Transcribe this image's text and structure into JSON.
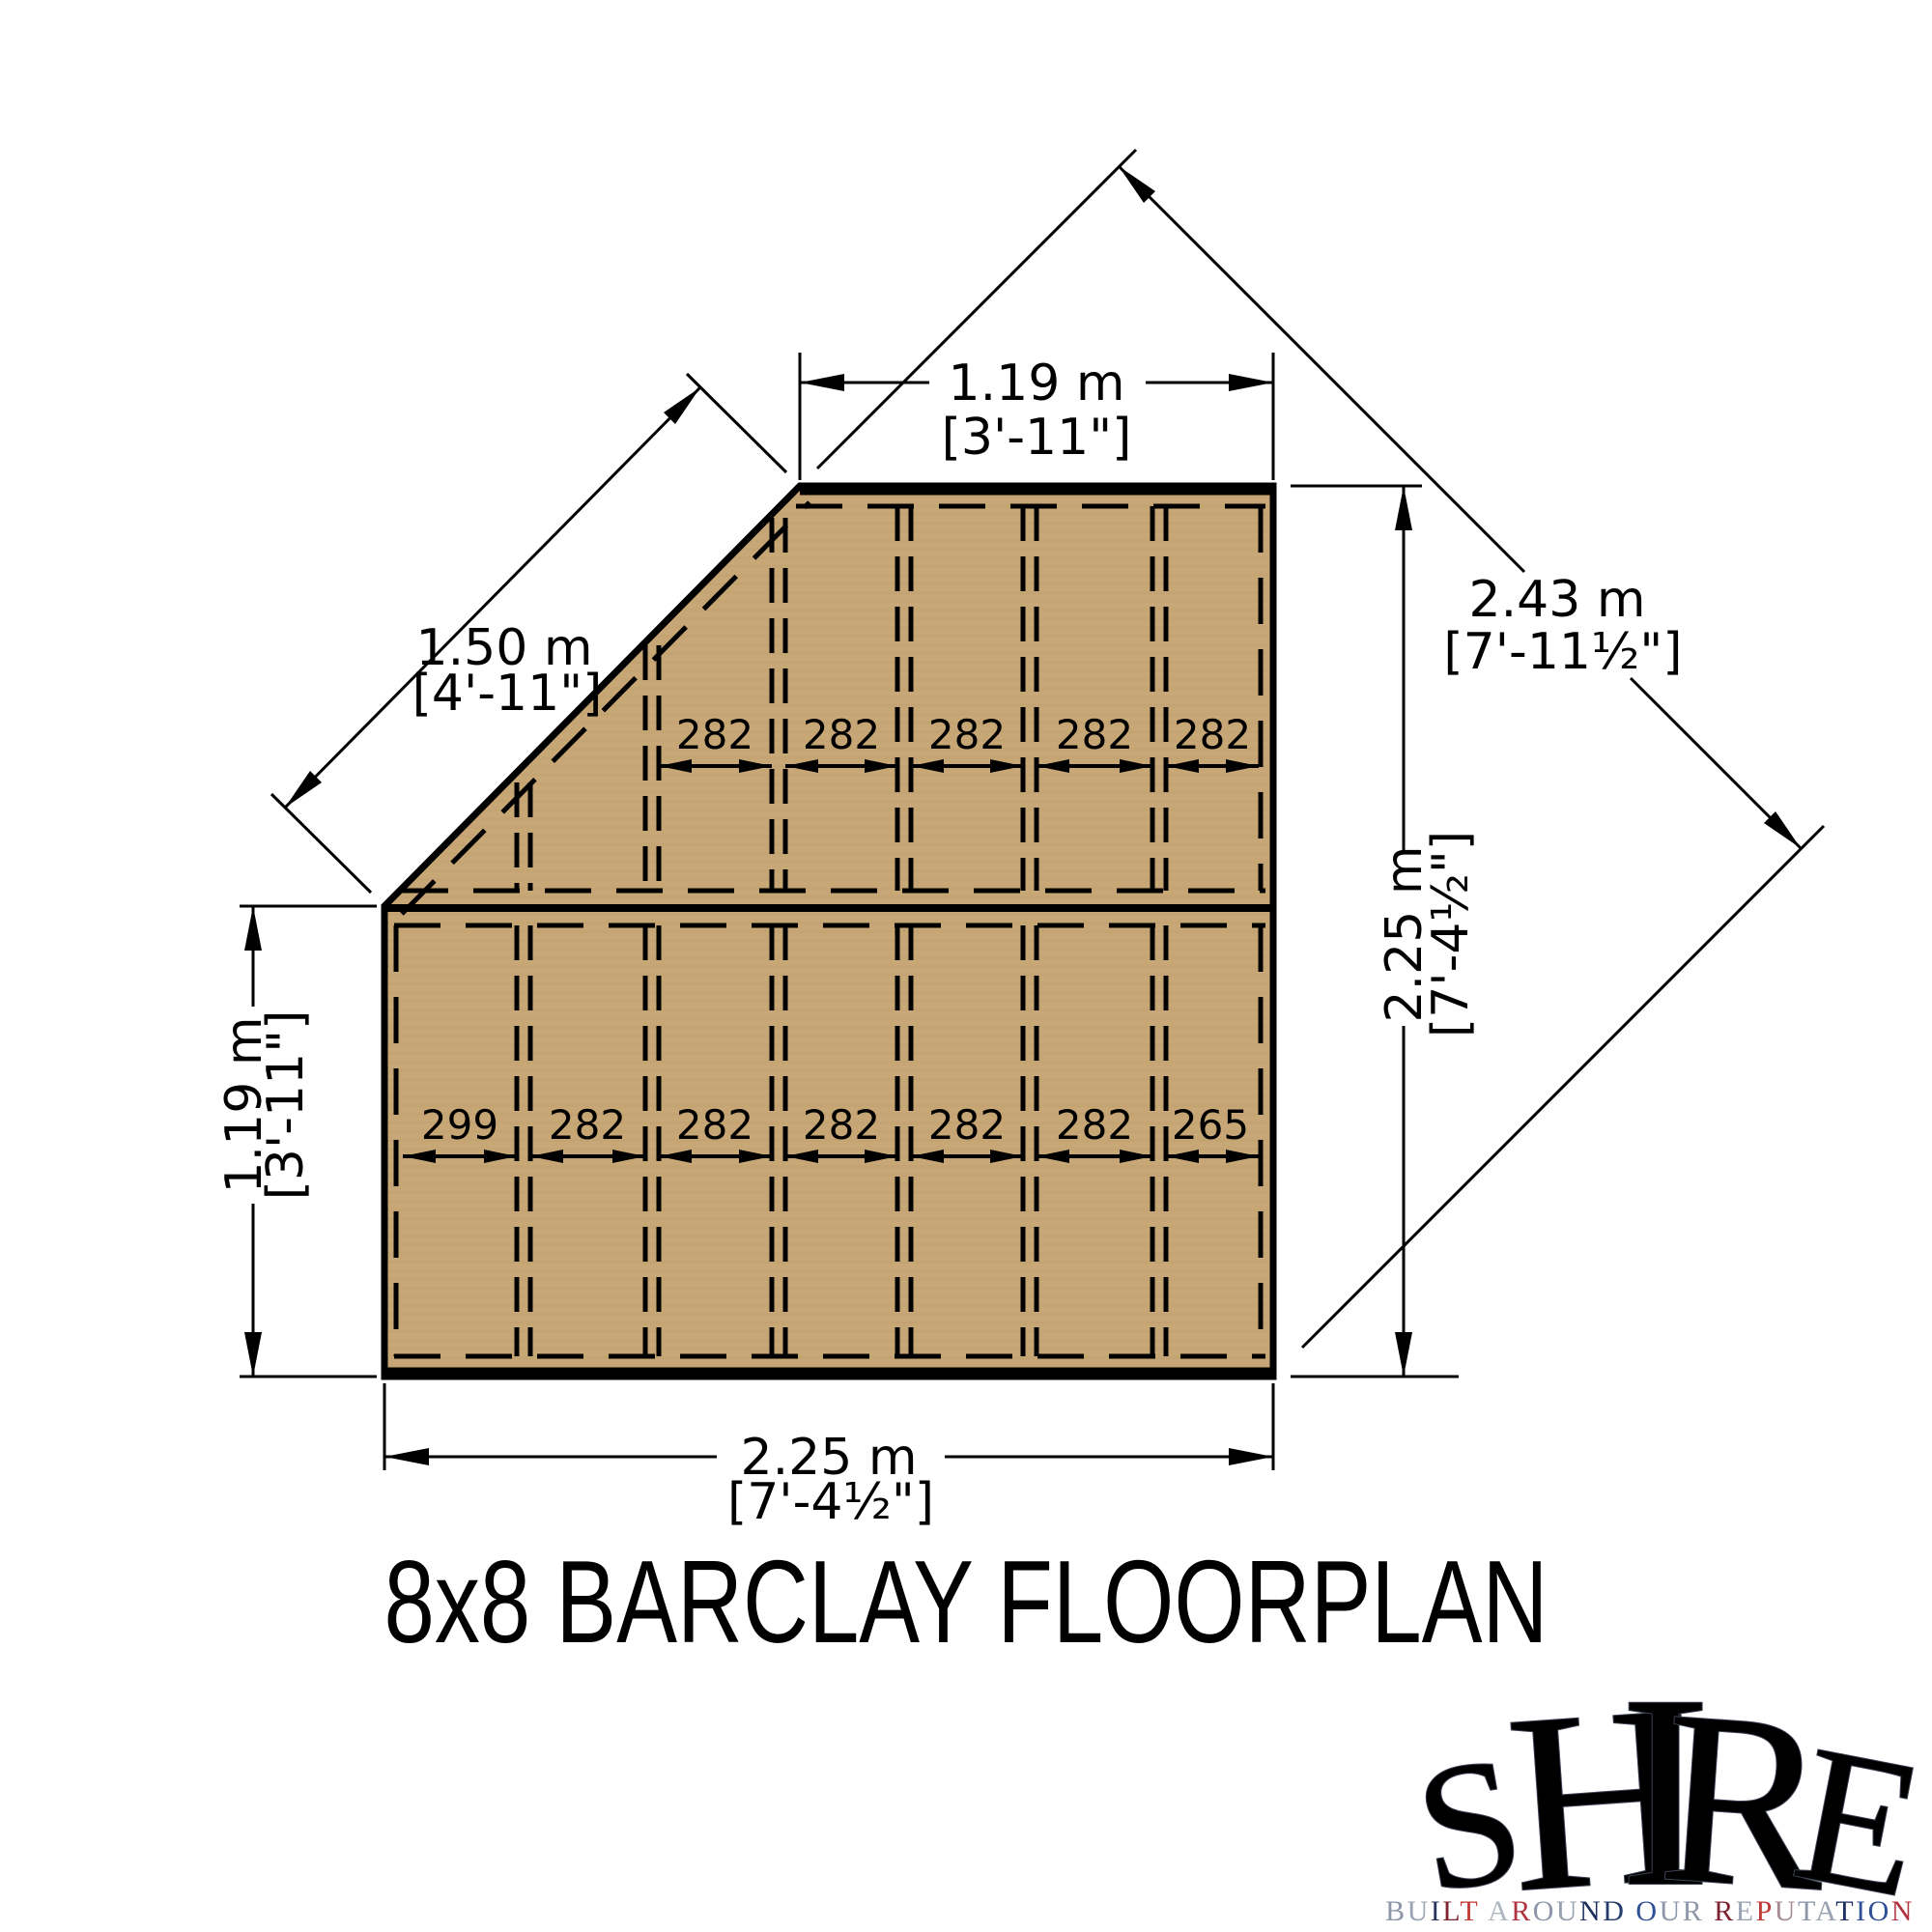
{
  "colors": {
    "floor": "#C8A777",
    "floor_grain": "#BFA06C",
    "line": "#000000",
    "flag_red": "#C8102E",
    "flag_blue": "#16275E",
    "flag_white": "#F2F4F7",
    "flag_silver": "#C7CDD8"
  },
  "dims": {
    "top": {
      "m": "1.19 m",
      "ft": "[3'-11\"]"
    },
    "left": {
      "m": "1.19 m",
      "ft": "[3'-11\"]"
    },
    "right": {
      "m": "2.25 m",
      "ft": "[7'-4½\"]"
    },
    "bottom": {
      "m": "2.25 m",
      "ft": "[7'-4½\"]"
    },
    "diag_wall": {
      "m": "1.50 m",
      "ft": "[4'-11\"]"
    },
    "diag_overall": {
      "m": "2.43 m",
      "ft": "[7'-11½\"]"
    }
  },
  "spacings": {
    "upper": [
      "282",
      "282",
      "282",
      "282",
      "282"
    ],
    "lower": [
      "299",
      "282",
      "282",
      "282",
      "282",
      "282",
      "265"
    ]
  },
  "title": "8x8 BARCLAY FLOORPLAN",
  "logo": {
    "word": "SHIRE",
    "letters": [
      "S",
      "H",
      "I",
      "R",
      "E"
    ],
    "tagline": "BUILT AROUND OUR REPUTATION",
    "tagline_colors": [
      "#8D96A8",
      "#9AA3B2",
      "#27335A",
      "#7D2330",
      "#C23A35",
      "#AEB6C2",
      "#B03340",
      "#8D96A8",
      "#97A0AE",
      "#1D2F5E",
      "#243A6B",
      "#2F4F96",
      "#8D96A8",
      "#8F98A9",
      "#7D2330",
      "#9AA3B2",
      "#C23A35",
      "#A48B93",
      "#8D96A8",
      "#9AA3B2",
      "#1D2F5E",
      "#2F4F96",
      "#2F4F96",
      "#B03340"
    ]
  }
}
